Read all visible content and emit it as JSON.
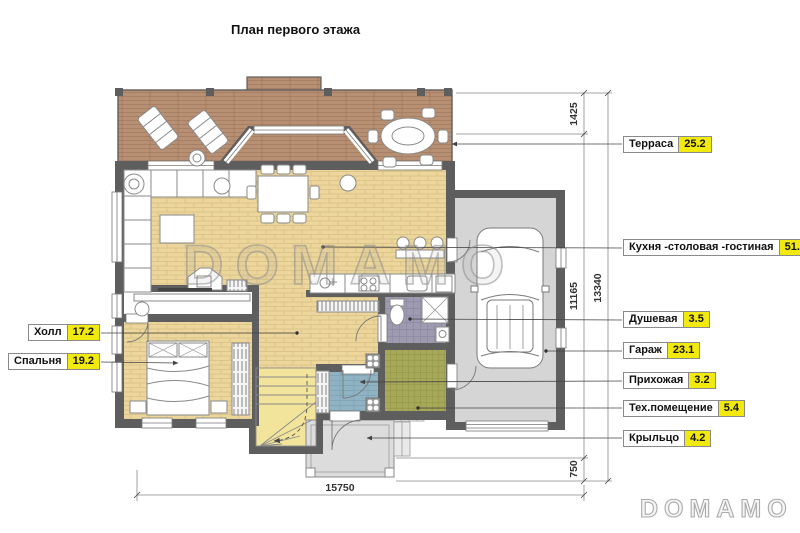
{
  "title": "План первого этажа",
  "watermark": {
    "center": "DOMAMO",
    "corner": "DOMAMO"
  },
  "rooms": {
    "left": [
      {
        "name": "Холл",
        "area": "17.2"
      },
      {
        "name": "Спальня",
        "area": "19.2"
      }
    ],
    "right": [
      {
        "name": "Терраса",
        "area": "25.2"
      },
      {
        "name": "Кухня -столовая -гостиная",
        "area": "51.9"
      },
      {
        "name": "Душевая",
        "area": "3.5"
      },
      {
        "name": "Гараж",
        "area": "23.1"
      },
      {
        "name": "Прихожая",
        "area": "3.2"
      },
      {
        "name": "Тех.помещение",
        "area": "5.4"
      },
      {
        "name": "Крыльцо",
        "area": "4.2"
      }
    ]
  },
  "dimensions": {
    "terrace_depth": "1425",
    "house_depth": "11165",
    "porch_depth": "750",
    "total_depth": "13340",
    "total_width": "15750"
  },
  "colors": {
    "area_badge": "#f2e90e",
    "wall": "#5f5e5e",
    "terrace_floor": "#b78f73",
    "interior_floor": "#ebd59b",
    "stairs_floor": "#f3e49b",
    "shower_floor": "#9e9bb1",
    "tech_floor": "#a8a958",
    "entry_floor": "#8fb3c3",
    "garage_floor": "#d5d5d5",
    "porch_floor": "#dcdcdc"
  }
}
